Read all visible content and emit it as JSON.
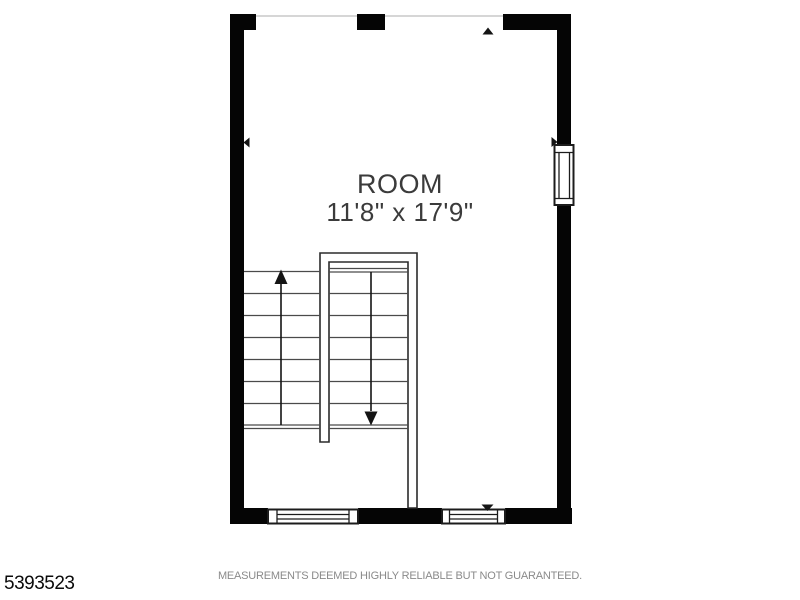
{
  "floor_plan": {
    "room": {
      "label": "ROOM",
      "dimensions": "11'8\" x 17'9\""
    },
    "stairs": {
      "left_flight_treads": 8,
      "right_flight_treads": 8,
      "up_arrow_icon": "arrow-up",
      "down_arrow_icon": "arrow-down"
    },
    "windows": {
      "right_wall_count": 1,
      "bottom_wall_count": 2
    },
    "wall_opening_markers": [
      "top",
      "left",
      "right",
      "bottom"
    ],
    "colors": {
      "wall": "#050505",
      "stair_line": "#4a4a4a",
      "thin_wall_line": "#2b2b2b",
      "window_line": "#1c1c1c",
      "room_text": "#3b3b3b",
      "disclaimer_text": "#8a8a8a",
      "listing_text": "#0a0a0a",
      "opening_line": "#c8c8c8"
    }
  },
  "footer": {
    "listing_number": "5393523",
    "disclaimer": "MEASUREMENTS DEEMED HIGHLY RELIABLE BUT NOT GUARANTEED."
  }
}
